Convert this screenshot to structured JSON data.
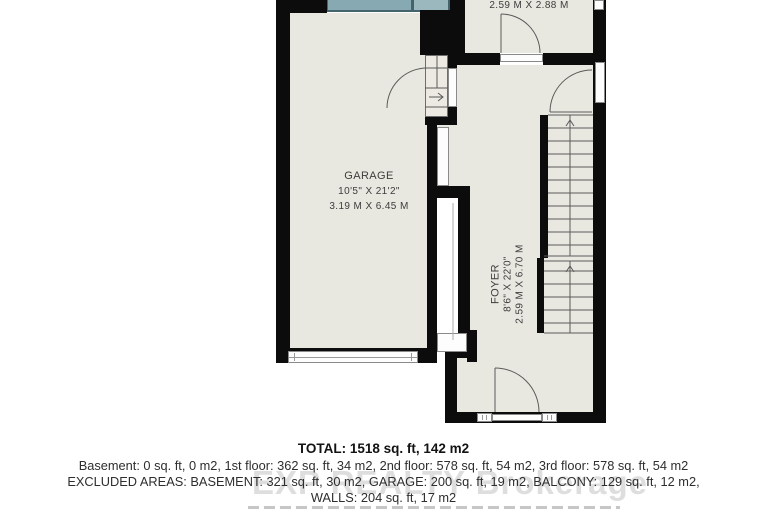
{
  "plan": {
    "rooms": {
      "garage": {
        "name": "GARAGE",
        "imperial": "10'5\" X 21'2\"",
        "metric": "3.19 M X 6.45 M"
      },
      "foyer": {
        "name": "FOYER",
        "imperial": "8'6\" X 22'0\"",
        "metric": "2.59 M X 6.70 M"
      },
      "top_room": {
        "metric": "2.59 M X 2.88 M"
      }
    },
    "colors": {
      "wall": "#0c0c0c",
      "floor": "#e9e8e0",
      "deck": "#87a9b1",
      "deck_border": "#44636c"
    }
  },
  "summary": {
    "total": "TOTAL: 1518 sq. ft, 142 m2",
    "floors": "Basement: 0 sq. ft, 0 m2, 1st floor: 362 sq. ft, 34 m2, 2nd floor: 578 sq. ft, 54 m2, 3rd floor: 578 sq. ft, 54 m2",
    "excluded": "EXCLUDED AREAS: BASEMENT: 321 sq. ft, 30 m2, GARAGE: 200 sq. ft, 19 m2, BALCONY: 129 sq. ft, 12 m2,",
    "walls": "WALLS: 204 sq. ft, 17 m2"
  },
  "watermark": {
    "text": "EXP REALTY Brokerage"
  }
}
